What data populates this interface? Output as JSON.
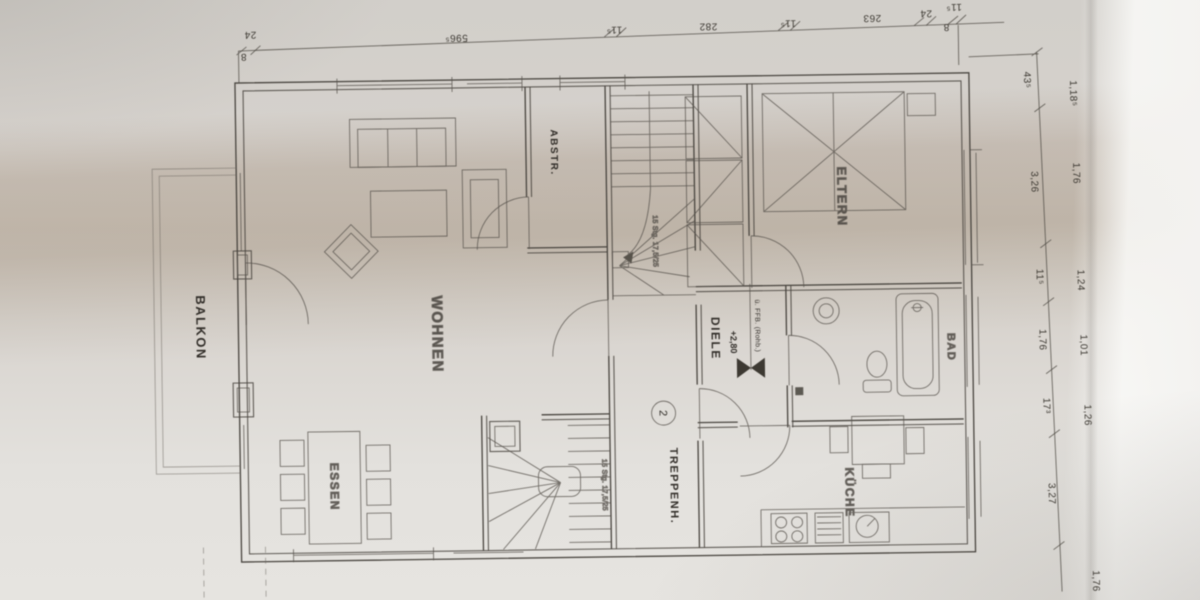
{
  "document": {
    "type": "photographed floor plan (Grundriss Obergeschoss)",
    "orientation_note": "plan rotated 90° in photo; room labels read vertically",
    "paper_color": "#d5d1cc",
    "shadow_band_color": "#96826e",
    "ink_color": "#46423c"
  },
  "labels": {
    "balkon": "BALKON",
    "wohnen": "WOHNEN",
    "essen": "ESSEN",
    "abstr": "ABSTR.",
    "treppenh": "TREPPENH.",
    "diele": "DIELE",
    "diele_level": "+2,80",
    "diele_note": "ü. FFB. (Rohb.)",
    "bad": "BAD",
    "kueche": "KÜCHE",
    "eltern": "ELTERN",
    "stair_note_upper": "15 Stg. 17,5/25",
    "stair_note_lower": "15 Stg. 17,5/25",
    "circle_mark": "2"
  },
  "dims": {
    "top": [
      "8",
      "24",
      "596⁵",
      "11⁵",
      "282",
      "11⁵",
      "263",
      "24",
      "11⁵",
      "8"
    ],
    "right_inner": [
      "43⁵",
      "3,26",
      "11⁵",
      "1,76",
      "17³",
      "3,27"
    ],
    "right_outer": [
      "1,18⁵",
      "1,76",
      "1,24",
      "1,01",
      "1,26",
      "1,76"
    ]
  }
}
